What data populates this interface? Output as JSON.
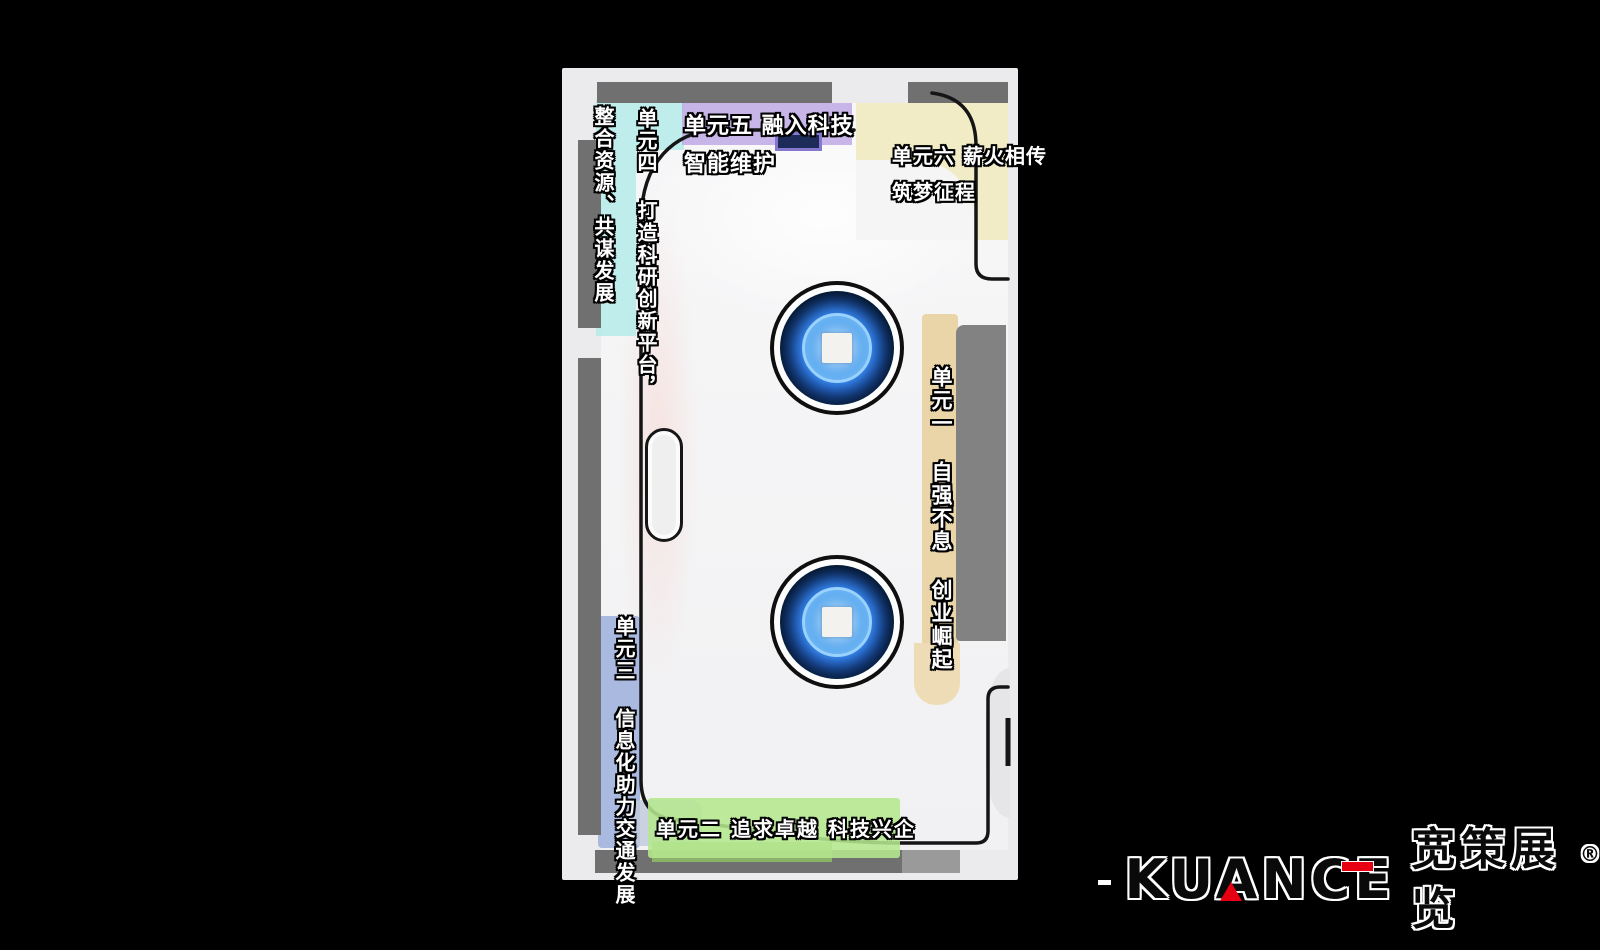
{
  "page": {
    "background_color": "#000000"
  },
  "plan": {
    "labels": {
      "theme": "整合资源、共谋发展",
      "unit1": "单元一 自强不息 创业崛起",
      "unit2": "单元二 追求卓越 科技兴企",
      "unit3": "单元三 信息化助力交通发展",
      "unit4": "单元四 打造科研创新平台，",
      "unit5_line1": "单元五 融入科技",
      "unit5_line2": "智能维护",
      "unit6_line1": "单元六 薪火相传",
      "unit6_line2": "筑梦征程"
    },
    "zone_colors": {
      "theme": "#b4ebe9",
      "unit1": "#e9d3a4",
      "unit2": "#b5e78e",
      "unit3": "#9fb0dc",
      "unit5": "#c1ace5",
      "unit6": "#f0ebc2"
    }
  },
  "logo": {
    "prefix_dash": "-",
    "brand": "KUANCE",
    "brand_cn": "宽策展览",
    "registered_mark": "®",
    "accent_color": "#e60012"
  }
}
